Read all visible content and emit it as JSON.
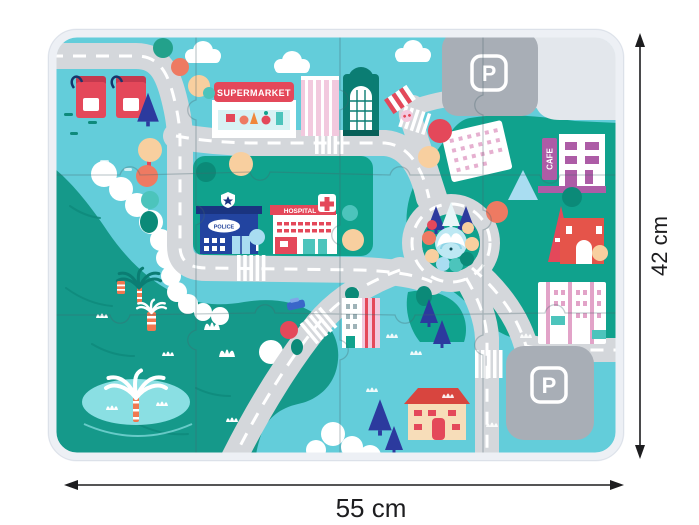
{
  "labels": {
    "supermarket": "SUPERMARKET",
    "hospital": "HOSPITAL",
    "police": "POLICE",
    "cafe": "CAFE",
    "parking": "P"
  },
  "dimensions": {
    "width": "55 cm",
    "height": "42 cm"
  },
  "palette": {
    "frame": "#edf0f5",
    "frameEdge": "#dce1e9",
    "sky": "#63cdda",
    "waterDark": "#15998a",
    "waterWave": "#0e8a7b",
    "waterLight": "#8adfe3",
    "park": "#10a28d",
    "parkDark": "#0b8a78",
    "road": "#d4d7db",
    "dash": "#ffffff",
    "parking": "#a8aeb6",
    "parkingLight": "#e3e7ec",
    "white": "#ffffff",
    "red": "#e4485a",
    "redDark": "#c4394e",
    "coral": "#ee7a62",
    "peach": "#f8cf9f",
    "navy": "#20419a",
    "pine": "#2c3a9e",
    "pink": "#f2c9de",
    "pinkDark": "#e2a3c8",
    "magenta": "#ad5ca6",
    "lightblue": "#a9ddf1",
    "tealBuilding": "#0b7d73",
    "tealLight": "#4cc4bc",
    "cream": "#f7ddb9",
    "ink": "#1d1d1f",
    "signTeal": "#d8f2f4",
    "pondBlue": "#bde8f3",
    "trunkOrange": "#f07850",
    "carBlue": "#3a66c9"
  }
}
